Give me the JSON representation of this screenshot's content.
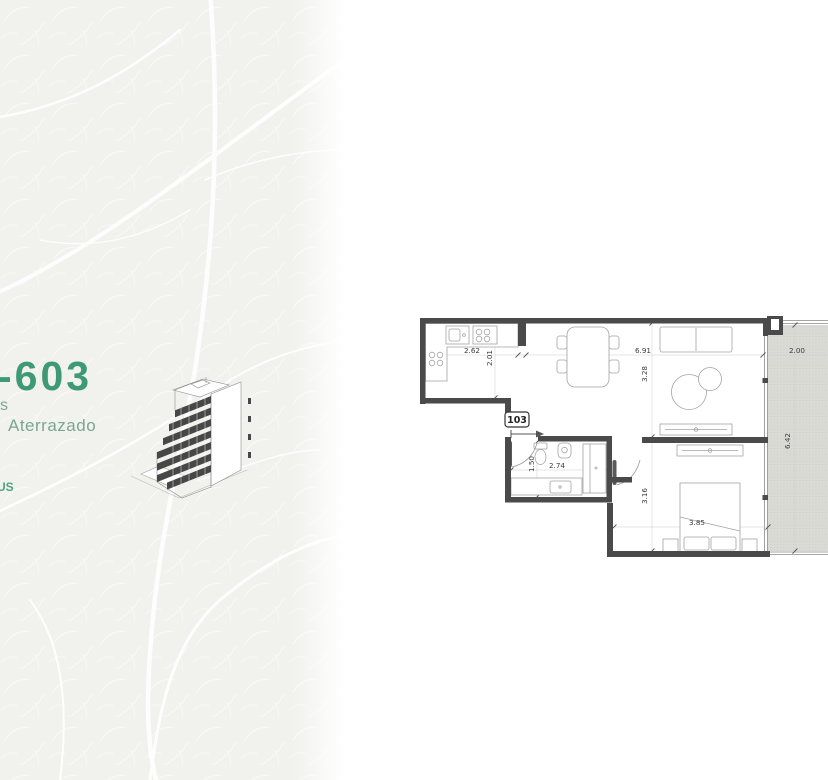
{
  "page": {
    "background": "#ffffff"
  },
  "left_panel": {
    "unit_number_fragment": "-603",
    "tagline_fragment_1": "s",
    "tagline_fragment_2": "Aterrazado",
    "footer_fragment": "US",
    "accent_green": "#3d9a74",
    "tagline_green": "#7aa791"
  },
  "floor_plan": {
    "unit_label": "103",
    "wall_color": "#4a4a4a",
    "terrace_fill": "#dbdbd6",
    "dims": {
      "kitchen_w": "2.62",
      "kitchen_d": "2.01",
      "living_w": "6.91",
      "living_d": "3.28",
      "bath_d": "1.50",
      "bath_w": "2.74",
      "bedroom_d": "3.16",
      "bedroom_w": "3.85",
      "terrace_w": "2.00",
      "terrace_d": "6.42"
    }
  }
}
